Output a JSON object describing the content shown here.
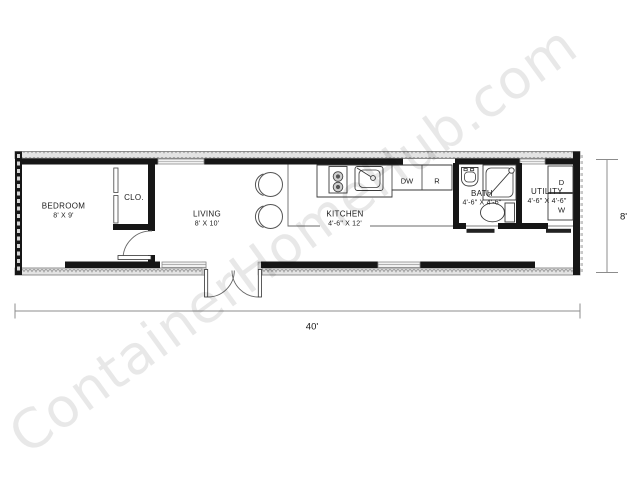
{
  "watermark": {
    "text": "ContainerHomeHub.com"
  },
  "rooms": {
    "bedroom": {
      "name": "BEDROOM",
      "dims": "8' X 9'"
    },
    "closet": {
      "name": "CLO."
    },
    "living": {
      "name": "LIVING",
      "dims": "8' X 10'"
    },
    "kitchen": {
      "name": "KITCHEN",
      "dims": "4'-6\" X 12'"
    },
    "bath": {
      "name": "BATH",
      "dims": "4'-6\" X 4'-6\""
    },
    "utility": {
      "name": "UTILITY",
      "dims": "4'-6\" X 4'-6\""
    }
  },
  "appliances": {
    "dishwasher": "DW",
    "refrigerator": "R",
    "dryer": "D",
    "washer": "W"
  },
  "overall_dimensions": {
    "width": "40'",
    "depth": "8'"
  },
  "colors": {
    "wall": "#161616",
    "corrugation_band": "#e3e3e3",
    "line": "#3a3a3a",
    "dimension_line": "#8c8c8c",
    "watermark_gray": "#e7e7e7"
  }
}
